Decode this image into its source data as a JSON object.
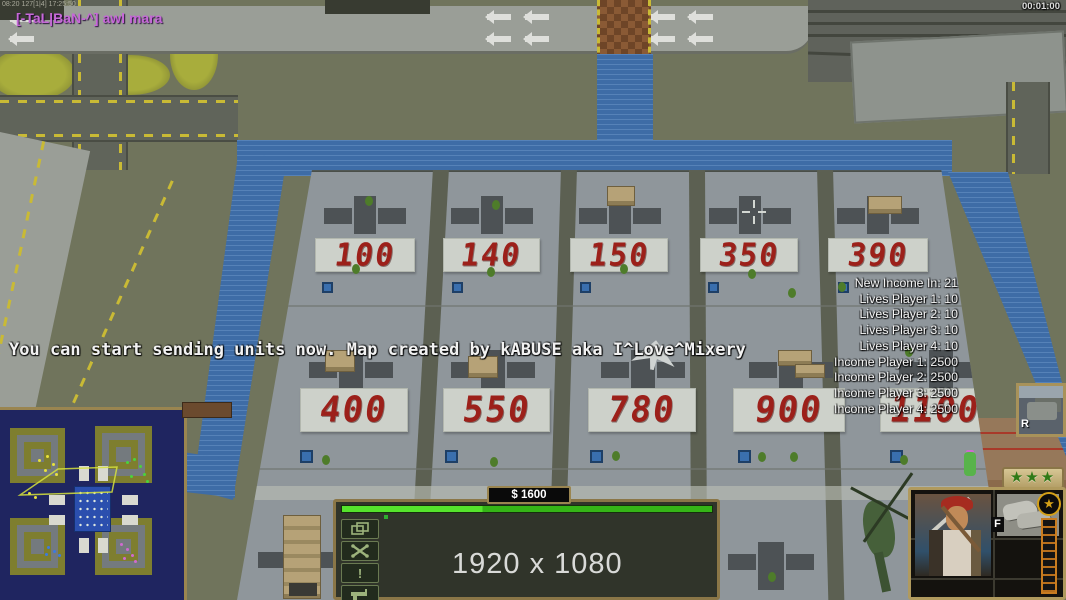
{
  "hud": {
    "debug_text": "08:20 127[1|4] 17:25:50",
    "chat_message": "[-TaL|BaN-^] awl mara",
    "timer": "00:01:00",
    "system_message": "You can start sending units now. Map created by kABUSE aka I^Love^Mixery",
    "watermark": "1920 x 1080"
  },
  "stats": {
    "lines": [
      "New Income In: 21",
      "Lives Player 1: 10",
      "Lives Player 2: 10",
      "Lives Player 3: 10",
      "Lives Player 4: 10",
      "Income Player 1: 2500",
      "Income Player 2: 2500",
      "Income Player 3: 2500",
      "Income Player 4: 2500"
    ]
  },
  "plaza": {
    "top_row": [
      "100",
      "140",
      "150",
      "350",
      "390"
    ],
    "bottom_row": [
      "400",
      "550",
      "780",
      "900",
      "1100"
    ]
  },
  "command_bar": {
    "money": "$ 1600",
    "unit_button_count": 14,
    "unit_button_label": "M",
    "unit_button_icon": "mine-detector-icon",
    "alert_glyph": "!",
    "side_button_icons": [
      "stack-icon",
      "wrench-icon",
      "alert-icon",
      "gun-icon"
    ]
  },
  "selection": {
    "thumb_label": "R",
    "inventory_label": "F",
    "rank_stars": "★★★",
    "star_glyph": "★"
  },
  "colors": {
    "accent_green": "#3ecc1e",
    "water_blue": "#3e6ca6",
    "price_red": "#9c201a",
    "chat_purple": "#c668d8",
    "frame_tan": "#b09a5e"
  }
}
